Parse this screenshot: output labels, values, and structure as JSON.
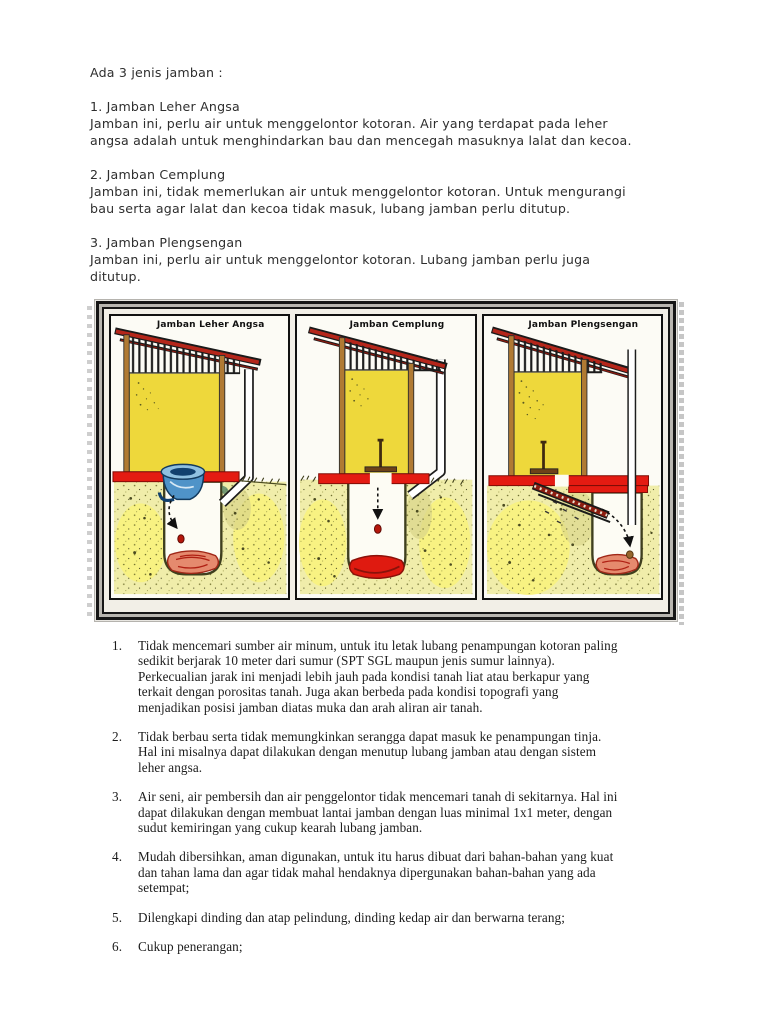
{
  "intro": {
    "lead": "Ada 3 jenis jamban :",
    "paragraphs": [
      "1. Jamban Leher Angsa\nJamban ini, perlu air untuk menggelontor kotoran. Air yang terdapat pada leher\nangsa adalah untuk menghindarkan bau dan mencegah masuknya lalat dan kecoa.",
      "2. Jamban Cemplung\nJamban ini, tidak memerlukan air untuk menggelontor kotoran. Untuk mengurangi\nbau serta agar lalat dan kecoa tidak masuk, lubang jamban perlu ditutup.",
      "3. Jamban Plengsengan\nJamban ini, perlu air untuk menggelontor kotoran. Lubang jamban perlu juga\nditutup."
    ]
  },
  "figure": {
    "panels": [
      {
        "title": "Jamban Leher Angsa"
      },
      {
        "title": "Jamban Cemplung"
      },
      {
        "title": "Jamban Plengsengan"
      }
    ],
    "colors": {
      "frame_silver": "#b9b6b0",
      "wall_yellow": "#eed83b",
      "slab_red": "#e41b12",
      "roof_red": "#b5261a",
      "soil": "#f0edaa",
      "pit_white": "#fdfcf4",
      "sludge_red": "#df1a10",
      "sludge_salmon": "#e58a6e",
      "bowl_blue": "#4f93c8",
      "wood_brown": "#b07a33"
    }
  },
  "requirements": {
    "items": [
      {
        "num": "1.",
        "text": "Tidak mencemari sumber air minum, untuk itu letak lubang penampungan kotoran paling\nsedikit berjarak 10 meter dari sumur (SPT SGL maupun jenis sumur lainnya).\nPerkecualian jarak ini menjadi lebih jauh pada kondisi tanah liat atau berkapur yang\nterkait dengan porositas tanah. Juga akan berbeda pada kondisi topografi yang\nmenjadikan posisi jamban diatas muka dan arah aliran  air tanah."
      },
      {
        "num": "2.",
        "text": "Tidak berbau serta tidak memungkinkan serangga dapat masuk ke penampungan tinja.\nHal ini misalnya dapat dilakukan dengan menutup lubang jamban atau dengan sistem\nleher angsa."
      },
      {
        "num": "3.",
        "text": "Air seni, air pembersih dan air penggelontor tidak mencemari tanah di sekitarnya. Hal ini\ndapat dilakukan dengan membuat lantai jamban dengan luas minimal 1x1 meter, dengan\nsudut kemiringan yang cukup kearah lubang jamban."
      },
      {
        "num": "4.",
        "text": "Mudah dibersihkan, aman digunakan, untuk itu harus dibuat dari bahan-bahan yang kuat\ndan tahan lama dan agar tidak mahal hendaknya dipergunakan bahan-bahan yang ada\nsetempat;"
      },
      {
        "num": "5.",
        "text": "Dilengkapi dinding dan atap pelindung, dinding kedap air dan berwarna terang;"
      },
      {
        "num": "6.",
        "text": "Cukup penerangan;"
      }
    ]
  }
}
